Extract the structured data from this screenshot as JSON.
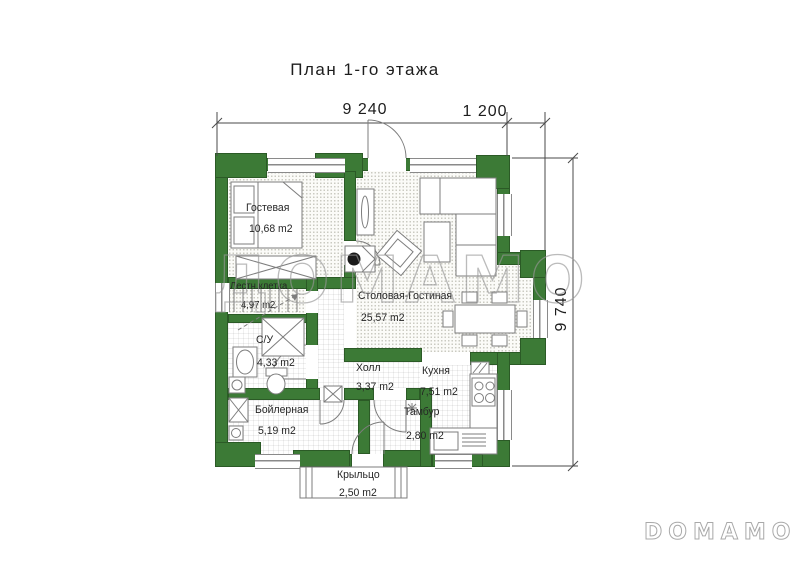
{
  "title": "План 1-го этажа",
  "dimensions": {
    "top_main": "9 240",
    "top_right": "1 200",
    "right_side": "9 740"
  },
  "rooms": [
    {
      "name": "Гостевая",
      "area": "10,68 m2"
    },
    {
      "name": "Лестн.клетка",
      "area": "4,97 m2"
    },
    {
      "name": "С/У",
      "area": "4,33 m2"
    },
    {
      "name": "Столовая-Гостиная",
      "area": "25,57 m2"
    },
    {
      "name": "Холл",
      "area": "3,37 m2"
    },
    {
      "name": "Кухня",
      "area": "7,51 m2"
    },
    {
      "name": "Бойлерная",
      "area": "5,19 m2"
    },
    {
      "name": "Тамбур",
      "area": "2,80 m2"
    },
    {
      "name": "Крыльцо",
      "area": "2,50 m2"
    }
  ],
  "watermark": {
    "center": "ДОМАМО",
    "corner": "DOMAMO"
  },
  "colors": {
    "wall_green": "#3c7a36",
    "wall_outline": "#2b5a26",
    "line_gray": "#7d7d7d",
    "text": "#262626",
    "watermark_gray": "#969696"
  }
}
